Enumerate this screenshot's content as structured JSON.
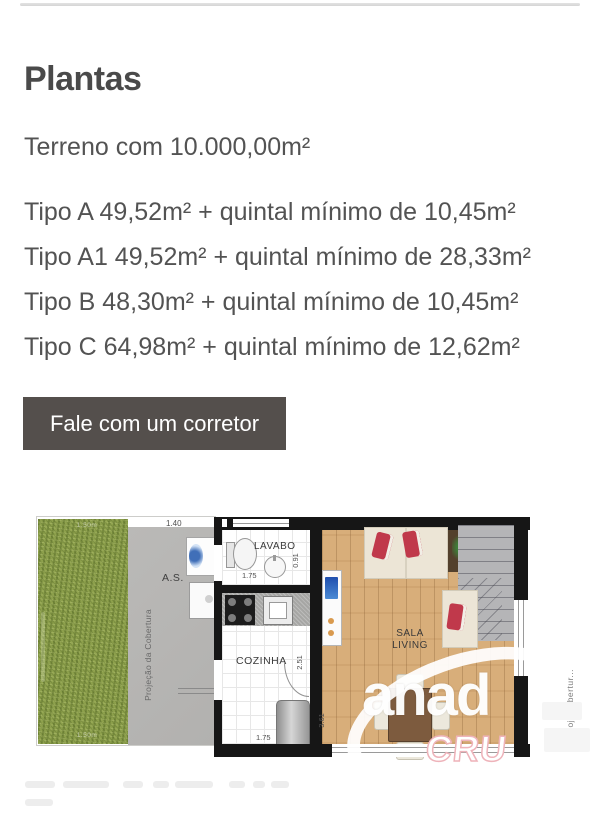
{
  "header": {
    "title": "Plantas"
  },
  "summary": {
    "terreno": "Terreno com 10.000,00m²",
    "tipos": [
      "Tipo A 49,52m² + quintal mínimo de 10,45m²",
      "Tipo A1 49,52m² + quintal mínimo de 28,33m²",
      "Tipo B 48,30m² + quintal mínimo de 10,45m²",
      "Tipo C 64,98m² + quintal mínimo de 12,62m²"
    ]
  },
  "cta": {
    "label": "Fale com um corretor"
  },
  "floorplan": {
    "rooms": {
      "as": "A.S.",
      "lavabo": "LAVABO",
      "cozinha": "COZINHA",
      "sala_line1": "SALA",
      "sala_line2": "LIVING"
    },
    "dimensions": {
      "top_width": "1.40",
      "lavabo_width": "1.75",
      "lavabo_depth": "0.91",
      "cozinha_depth": "2.51",
      "cozinha_width": "1.75",
      "sala_depth": "3.61"
    },
    "annotations": {
      "projecao": "Projeção da Cobertura",
      "proj_cobertura_right": "Proj. Cobertur...",
      "grass_top": "1.50m",
      "grass_bottom": "1.50m"
    },
    "watermark": {
      "main": "anad",
      "sub": "CRU"
    },
    "colors": {
      "grass": "#8DA04C",
      "wood": "#D8AE7A",
      "wall": "#161616",
      "concrete": "#B7B6B4"
    }
  },
  "theme": {
    "button_bg": "#544F4C",
    "heading_color": "#4A4A4A",
    "body_color": "#535353"
  }
}
